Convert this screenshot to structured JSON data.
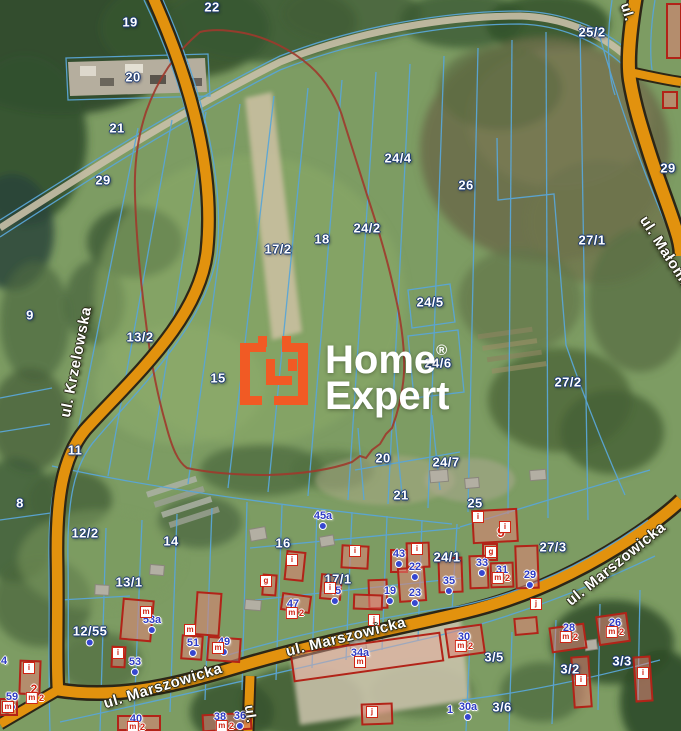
{
  "watermark": {
    "line1": "Home",
    "reg": "®",
    "line2": "Expert"
  },
  "colors": {
    "logo_orange": "#f15a24",
    "road_fill": "#e2920e",
    "road_casing": "#2c2617",
    "cadastral_line": "#5aa6d6",
    "parcel_text": "#ffffff",
    "address_text": "#2f3cc4",
    "building_red": "#b22318",
    "boundary_red": "#9e3a2c"
  },
  "map": {
    "street_labels": [
      {
        "t": "ul. Krzelowska",
        "x": 76,
        "y": 362,
        "rot": -79
      },
      {
        "t": "ul. Marszowicka",
        "x": 163,
        "y": 686,
        "rot": -17
      },
      {
        "t": "ul. Marszowicka",
        "x": 346,
        "y": 637,
        "rot": -14
      },
      {
        "t": "ul. Marszowicka",
        "x": 616,
        "y": 564,
        "rot": -39
      },
      {
        "t": "ul. Małomicka",
        "x": 672,
        "y": 262,
        "rot": 57
      },
      {
        "t": "ul.",
        "x": 628,
        "y": 12,
        "rot": 73,
        "fs": 14
      },
      {
        "t": "ul.",
        "x": 251,
        "y": 714,
        "rot": 82,
        "fs": 14
      }
    ],
    "parcel_labels": [
      {
        "t": "19",
        "x": 130,
        "y": 22
      },
      {
        "t": "22",
        "x": 212,
        "y": 7
      },
      {
        "t": "20",
        "x": 133,
        "y": 77
      },
      {
        "t": "21",
        "x": 117,
        "y": 128
      },
      {
        "t": "29",
        "x": 103,
        "y": 180
      },
      {
        "t": "25/2",
        "x": 592,
        "y": 32
      },
      {
        "t": "24/4",
        "x": 398,
        "y": 158
      },
      {
        "t": "26",
        "x": 466,
        "y": 185
      },
      {
        "t": "29",
        "x": 668,
        "y": 168
      },
      {
        "t": "24/2",
        "x": 367,
        "y": 228
      },
      {
        "t": "18",
        "x": 322,
        "y": 239
      },
      {
        "t": "17/2",
        "x": 278,
        "y": 249
      },
      {
        "t": "27/1",
        "x": 592,
        "y": 240
      },
      {
        "t": "24/5",
        "x": 430,
        "y": 302
      },
      {
        "t": "9",
        "x": 30,
        "y": 315
      },
      {
        "t": "13/2",
        "x": 140,
        "y": 337
      },
      {
        "t": "24/6",
        "x": 438,
        "y": 363
      },
      {
        "t": "15",
        "x": 218,
        "y": 378
      },
      {
        "t": "27/2",
        "x": 568,
        "y": 382
      },
      {
        "t": "11",
        "x": 75,
        "y": 450
      },
      {
        "t": "20",
        "x": 383,
        "y": 458
      },
      {
        "t": "24/7",
        "x": 446,
        "y": 462
      },
      {
        "t": "21",
        "x": 401,
        "y": 495
      },
      {
        "t": "8",
        "x": 20,
        "y": 503
      },
      {
        "t": "25",
        "x": 475,
        "y": 503
      },
      {
        "t": "12/2",
        "x": 85,
        "y": 533
      },
      {
        "t": "14",
        "x": 171,
        "y": 541
      },
      {
        "t": "16",
        "x": 283,
        "y": 543
      },
      {
        "t": "27/3",
        "x": 553,
        "y": 547
      },
      {
        "t": "24/1",
        "x": 447,
        "y": 557
      },
      {
        "t": "13/1",
        "x": 129,
        "y": 582
      },
      {
        "t": "17/1",
        "x": 338,
        "y": 579
      },
      {
        "t": "12/55",
        "x": 90,
        "y": 631,
        "dot": true
      },
      {
        "t": "3/5",
        "x": 494,
        "y": 657
      },
      {
        "t": "3/3",
        "x": 622,
        "y": 661
      },
      {
        "t": "3/2",
        "x": 570,
        "y": 669
      },
      {
        "t": "3/6",
        "x": 502,
        "y": 707
      }
    ],
    "address_labels": [
      {
        "t": "45a",
        "x": 323,
        "y": 516,
        "dot": true
      },
      {
        "t": "43",
        "x": 399,
        "y": 554,
        "dot": true
      },
      {
        "t": "22",
        "x": 415,
        "y": 567,
        "dot": true
      },
      {
        "t": "33",
        "x": 482,
        "y": 563,
        "dot": true
      },
      {
        "t": "31",
        "x": 502,
        "y": 570
      },
      {
        "t": "29",
        "x": 530,
        "y": 575,
        "dot": true
      },
      {
        "t": "35",
        "x": 449,
        "y": 581,
        "dot": true
      },
      {
        "t": "19",
        "x": 390,
        "y": 591,
        "dot": true
      },
      {
        "t": "23",
        "x": 415,
        "y": 593,
        "dot": true
      },
      {
        "t": "45",
        "x": 335,
        "y": 591,
        "dot": true
      },
      {
        "t": "47",
        "x": 293,
        "y": 604,
        "dot": true
      },
      {
        "t": "53a",
        "x": 152,
        "y": 620,
        "dot": true
      },
      {
        "t": "51",
        "x": 193,
        "y": 643,
        "dot": true
      },
      {
        "t": "49",
        "x": 224,
        "y": 642,
        "dot": true
      },
      {
        "t": "53",
        "x": 135,
        "y": 662,
        "dot": true
      },
      {
        "t": "59",
        "x": 12,
        "y": 697,
        "dot": true
      },
      {
        "t": "34a",
        "x": 360,
        "y": 653,
        "dot": true
      },
      {
        "t": "40",
        "x": 136,
        "y": 719,
        "dot": true
      },
      {
        "t": "38",
        "x": 220,
        "y": 717,
        "dot": true
      },
      {
        "t": "36",
        "x": 240,
        "y": 716,
        "dot": true
      },
      {
        "t": "30",
        "x": 464,
        "y": 637
      },
      {
        "t": "28",
        "x": 569,
        "y": 628
      },
      {
        "t": "26",
        "x": 615,
        "y": 623
      },
      {
        "t": "30a",
        "x": 468,
        "y": 707,
        "dot": true
      },
      {
        "t": "1",
        "x": 450,
        "y": 710
      },
      {
        "t": "4",
        "x": 4,
        "y": 661
      }
    ],
    "red_labels": [
      {
        "t": "9",
        "x": 501,
        "y": 532,
        "fs": 14
      },
      {
        "t": "2",
        "x": 34,
        "y": 689,
        "fs": 12
      }
    ],
    "building_markers": [
      {
        "t": "m",
        "x": 146,
        "y": 612
      },
      {
        "t": "i",
        "x": 118,
        "y": 653
      },
      {
        "t": "m",
        "x": 190,
        "y": 630
      },
      {
        "t": "m",
        "x": 218,
        "y": 648
      },
      {
        "t": "i",
        "x": 29,
        "y": 668
      },
      {
        "t": "m2",
        "x": 35,
        "y": 698
      },
      {
        "t": "m",
        "x": 8,
        "y": 707
      },
      {
        "t": "i",
        "x": 292,
        "y": 560
      },
      {
        "t": "g",
        "x": 266,
        "y": 581
      },
      {
        "t": "i",
        "x": 330,
        "y": 588
      },
      {
        "t": "i",
        "x": 355,
        "y": 551
      },
      {
        "t": "j",
        "x": 374,
        "y": 620
      },
      {
        "t": "i",
        "x": 417,
        "y": 549
      },
      {
        "t": "m2",
        "x": 295,
        "y": 613
      },
      {
        "t": "i",
        "x": 478,
        "y": 517
      },
      {
        "t": "i",
        "x": 505,
        "y": 527
      },
      {
        "t": "g",
        "x": 491,
        "y": 552
      },
      {
        "t": "m2",
        "x": 501,
        "y": 578
      },
      {
        "t": "m2",
        "x": 464,
        "y": 646
      },
      {
        "t": "m2",
        "x": 569,
        "y": 637
      },
      {
        "t": "m2",
        "x": 615,
        "y": 632
      },
      {
        "t": "j",
        "x": 536,
        "y": 604
      },
      {
        "t": "i",
        "x": 581,
        "y": 680
      },
      {
        "t": "i",
        "x": 643,
        "y": 673
      },
      {
        "t": "m",
        "x": 360,
        "y": 662
      },
      {
        "t": "j",
        "x": 372,
        "y": 712
      },
      {
        "t": "m2",
        "x": 136,
        "y": 727
      },
      {
        "t": "m2",
        "x": 225,
        "y": 726
      }
    ]
  }
}
